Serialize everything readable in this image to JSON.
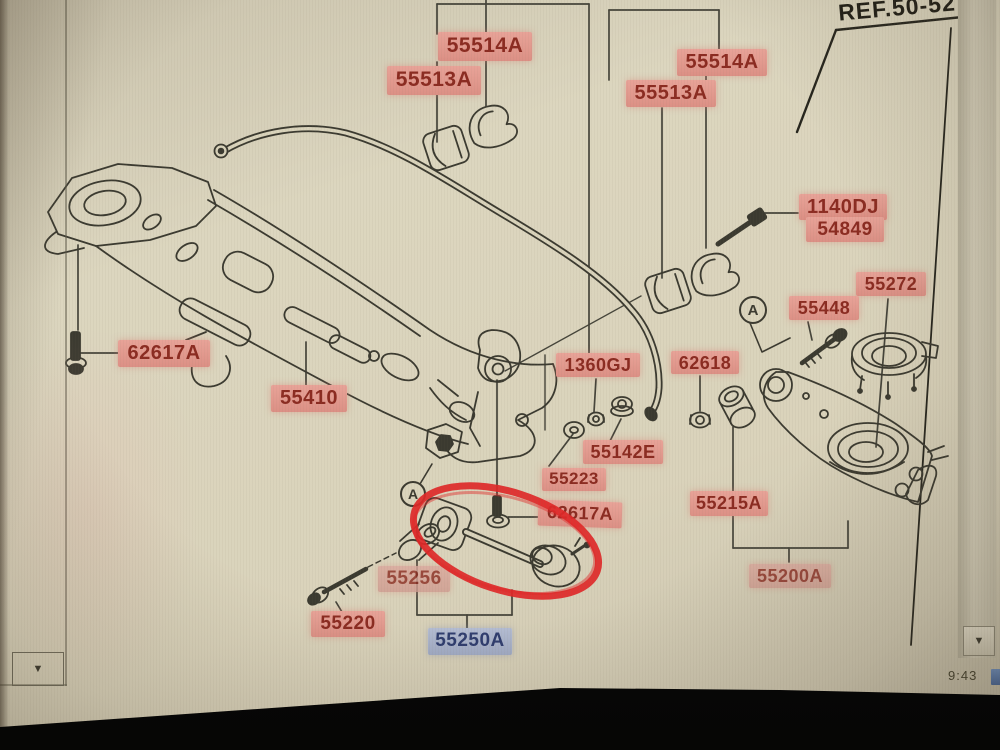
{
  "ref": {
    "label": "REF.50-527"
  },
  "parts": {
    "l55514a_left": "55514A",
    "l55513a_left": "55513A",
    "l55514a_right": "55514A",
    "l55513a_right": "55513A",
    "l1140dj": "1140DJ",
    "l54849": "54849",
    "l55272": "55272",
    "l55448": "55448",
    "l62618": "62618",
    "l1360gj": "1360GJ",
    "l55142e": "55142E",
    "l55223": "55223",
    "l62617a_mid": "62617A",
    "l55215a": "55215A",
    "l55200a": "55200A",
    "l62617a_left": "62617A",
    "l55410": "55410",
    "l55256": "55256",
    "l55220": "55220",
    "l55250a": "55250A"
  },
  "markers": {
    "a_left": "A",
    "a_right": "A"
  },
  "scrollbar": {
    "down_arrow": "▼"
  },
  "status": {
    "clock": "9:43"
  },
  "colors": {
    "label_pink": "#e29a8f",
    "label_pink_text": "#8b2b21",
    "label_blue": "#a9b2c9",
    "label_blue_text": "#2f3d6e",
    "annotation_red": "#e02828",
    "line_art": "#3b3a30",
    "screen_bg": "#d9d3bb"
  }
}
